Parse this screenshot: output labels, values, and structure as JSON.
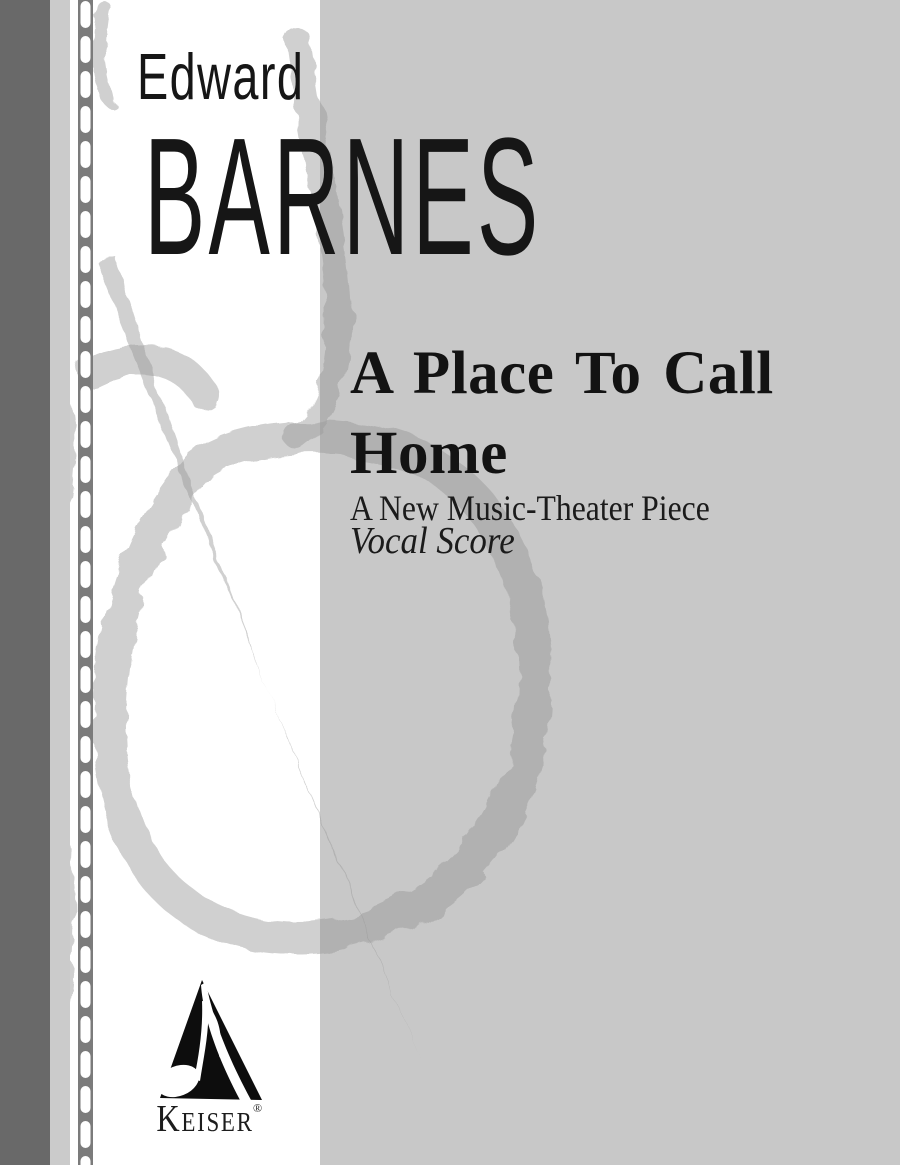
{
  "page": {
    "kind": "vocal score cover",
    "background_color": "#ffffff",
    "panel_color": "#c8c8c8",
    "spine_bar_color": "#696969",
    "spine_strip_color": "#cbcbcb",
    "stitch_band_color": "#7b7b7b",
    "stitch_dash_color": "#ffffff",
    "watermark_color": "rgba(150,150,150,0.45)",
    "text_color": "#131313"
  },
  "composer": {
    "first_name": "Edward",
    "last_name": "BARNES"
  },
  "work": {
    "title": "A Place To Call Home",
    "subtitle": "A New Music-Theater Piece",
    "edition": "Vocal Score"
  },
  "publisher": {
    "name": "Keiser",
    "registered_mark": "®"
  },
  "icons": {
    "watermark": "treble-clef-brush",
    "logo": "triangle-eighth-note",
    "spine": "stitch-dashed-line"
  }
}
